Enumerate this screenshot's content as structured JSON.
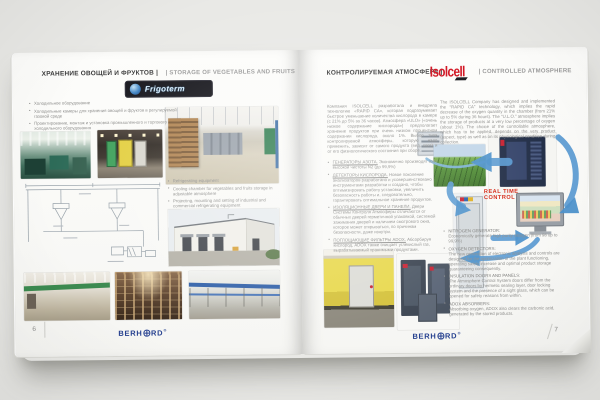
{
  "colors": {
    "background": "#e9e9e6",
    "page": "#fbfbf9",
    "heading_dark": "#3b3b3b",
    "heading_muted": "#9b9b9b",
    "body_text": "#8f8f8d",
    "accent_red_isolcell": "#d1101e",
    "accent_red_label": "#d42310",
    "diagram_arrow_blue": "#5b9bd2",
    "brand_navy": "#243f8f"
  },
  "icons": {
    "frigoterm-globe-icon": "blue globe sphere",
    "berhord-globe-icon": "circle with meridian lines used as letter O",
    "isolcell-swoosh-icon": "black skewed wedge under logotype"
  },
  "left_page": {
    "page_number": "6",
    "header_ru": "ХРАНЕНИЕ ОВОЩЕЙ И ФРУКТОВ |",
    "header_en": "| STORAGE OF VEGETABLES AND FRUITS",
    "brand": "Frigoterm",
    "bullets_ru": [
      "Холодильное оборудование",
      "Холодильные камеры для хранения овощей и фруктов в регулируемой газовой среде",
      "Проектирование, монтаж и установка промышленного и торгового холодильного оборудования"
    ],
    "bullets_en": [
      "Refrigerating equipment",
      "Cooling chamber for vegetables and fruits storage in adjustable atmosphere",
      "Projecting, mounting and setting of industrial and commercial refrigerating equipment"
    ]
  },
  "right_page": {
    "page_number": "7",
    "header_ru": "КОНТРОЛИРУЕМАЯ АТМОСФЕРА |",
    "header_en": "| CONTROLLED ATMOSPHERE",
    "brand": "Isolcell",
    "intro_ru": "Компания ISOLCELL разработала и внедрила технологию «RAPID CA», которая подразумевает быстрое уменьшение количества кислорода в камере (с 21% до 5% за 36 часов). Атмосфера «ULO» («очень низкое содержание кислорода») предполагает хранение продуктов при очень низком процентном содержании кислорода, около 1%. Выбор типа контролируемой атмосферы, которую надо применить, зависит от самого продукта (вид, сорт) и от его физиологического состояния при сборе.",
    "intro_en": "The ISOLCELL Company has designed and implemented the \"RAPID CA\" technology, which implies the rapid decrease of the oxygen quantity in the chamber (from 21% up to 5% during 36 hours). The \"U.L.O.\" atmosphere implies the storage of products at a very low percentage of oxygen (about 1%). The choice of the controllable atmosphere, which has to be applied, depends on the very product (aspect, type) as well as on its physiological condition during collection.",
    "bullets_ru": [
      {
        "title": "ГЕНЕРАТОРЫ АЗОТА.",
        "text": "Экономично производят азот высокой чистоты N2 (до 99,9%)"
      },
      {
        "title": "ДЕТЕКТОРЫ КИСЛОРОДА.",
        "text": "Новое поколение анализаторов разработано и усовершенствовано инструментами разработки и создано, чтобы оптимизировать работу установки, увеличить безопасность работы и, следовательно, гарантировать оптимальное хранение продуктов."
      },
      {
        "title": "ИЗОЛЯЦИОННЫЕ ДВЕРИ И ПАНЕЛИ.",
        "text": "Двери Системы Контроля Атмосферы отличаются от обычных дверей герметичной упаковкой, системой зажимания дверей и наличием смотрового окна, которое может открываться, по причинам безопасности, даже изнутри."
      },
      {
        "title": "ПОГЛОЩАЮЩИЕ ФИЛЬТРЫ ADOX.",
        "text": "Абсорбируя кислород, ADOX также очищает углекислый газ, вырабатываемый хранимыми продуктами."
      }
    ],
    "bullets_en": [
      {
        "title": "NITROGEN GENERATOR:",
        "text": "Economically generate high purity nitrogen (from 98 up to 99,9%)"
      },
      {
        "title": "OXYGEN DETECTORS:",
        "text": "The new generation of electronic analysis and controls are designed for the optimization of the plant functioning, operating safety increase and optimal product storage guaranteeing consequently."
      },
      {
        "title": "INSULATION DOORS AND PANELS:",
        "text": "The Atmosphere Control System doors differ from the ordinary doors by hermetic sealing layer, door locking system and the presence of a sight glass, which can be opened for safety reasons from within."
      },
      {
        "title": "ADOX ABSORBERS:",
        "text": "Absorbing oxygen, ADOX also clears the carbonic acid, generated by the stored products."
      }
    ],
    "diagram_label_line1": "REAL TIME",
    "diagram_label_line2": "CONTROL"
  },
  "footer": {
    "brand_prefix": "BERH",
    "brand_suffix": "RD",
    "registered": "®"
  }
}
